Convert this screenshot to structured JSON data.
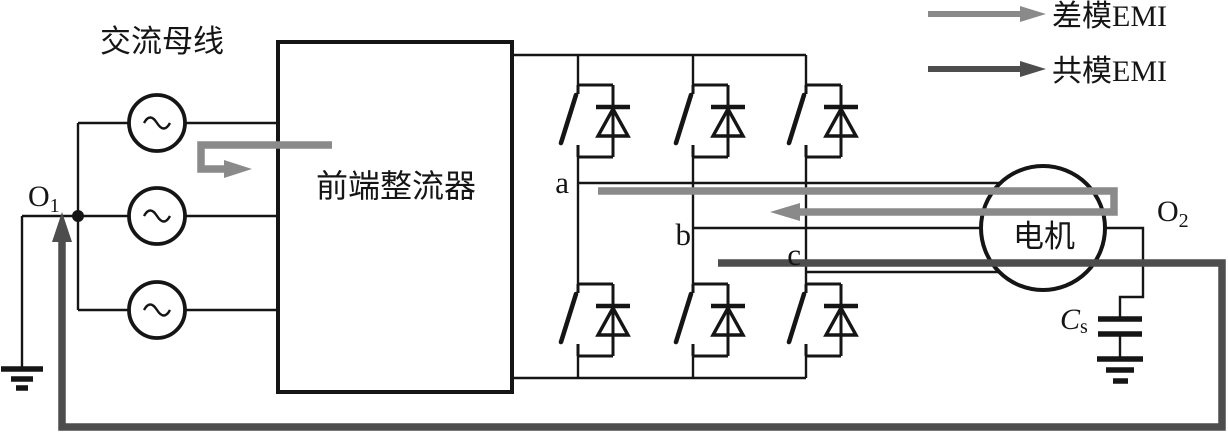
{
  "diagram_title": "交流母线",
  "legend": {
    "items": [
      {
        "label": "差模EMI",
        "color": "#8a8a8a"
      },
      {
        "label": "共模EMI",
        "color": "#4d4d4d"
      }
    ]
  },
  "blocks": {
    "rectifier_label": "前端整流器",
    "motor_label": "电机"
  },
  "nodes": {
    "o1": {
      "base": "O",
      "sub": "1"
    },
    "o2": {
      "base": "O",
      "sub": "2"
    }
  },
  "phases": {
    "a": "a",
    "b": "b",
    "c": "c"
  },
  "capacitor": {
    "base": "C",
    "sub": "s"
  },
  "colors": {
    "wire": "#151515",
    "dm_emi": "#8a8a8a",
    "cm_emi": "#4d4d4d",
    "background": "#ffffff"
  }
}
